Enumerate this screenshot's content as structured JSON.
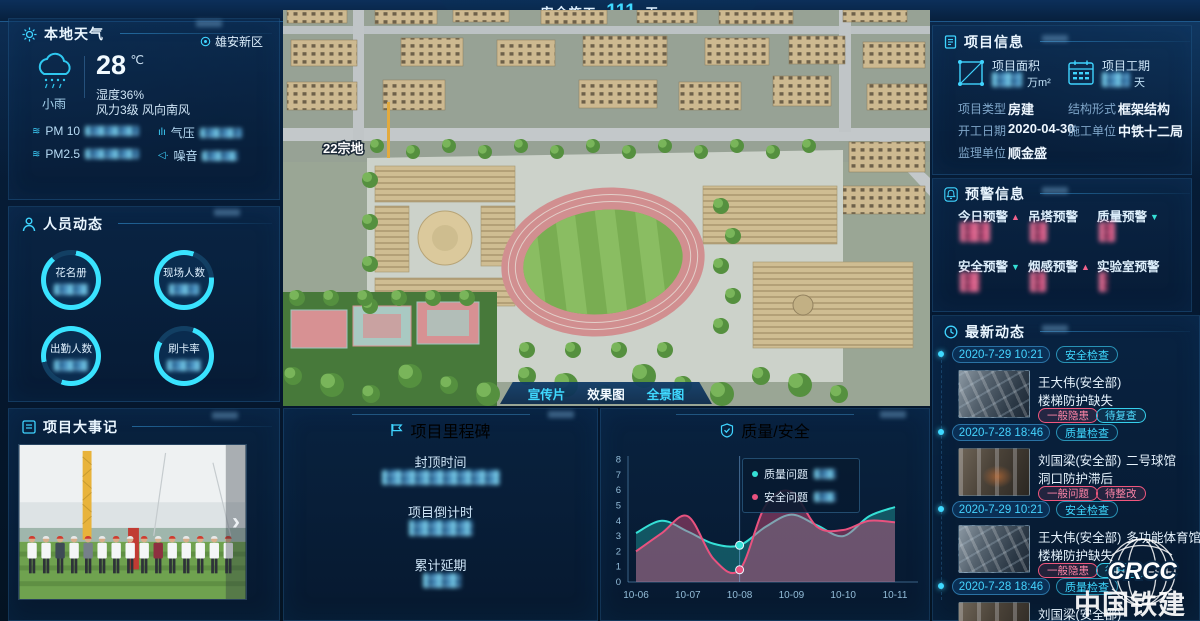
{
  "header": {
    "prefix": "安全施工",
    "days": "111",
    "suffix": "天"
  },
  "weather": {
    "title": "本地天气",
    "region": "雄安新区",
    "condition": "小雨",
    "temperature": "28",
    "temp_unit": "℃",
    "humidity": "湿度36%",
    "wind": "风力3级 风向南风",
    "metrics": [
      {
        "label": "PM 10",
        "icon": "pm-waves-icon"
      },
      {
        "label": "气压",
        "icon": "pressure-icon"
      },
      {
        "label": "PM2.5",
        "icon": "pm-waves-icon"
      },
      {
        "label": "噪音",
        "icon": "noise-speaker-icon"
      }
    ]
  },
  "personnel": {
    "title": "人员动态",
    "gauges": [
      {
        "label": "花名册"
      },
      {
        "label": "现场人数"
      },
      {
        "label": "出勤人数"
      },
      {
        "label": "刷卡率"
      }
    ]
  },
  "events": {
    "title": "项目大事记",
    "next_label": "›"
  },
  "scene": {
    "plot_label": "22宗地",
    "buttons": [
      {
        "label": "宣传片",
        "active": false
      },
      {
        "label": "效果图",
        "active": true
      },
      {
        "label": "全景图",
        "active": false
      }
    ]
  },
  "milestone": {
    "title": "项目里程碑",
    "items": [
      {
        "label": "封顶时间"
      },
      {
        "label": "项目倒计时"
      },
      {
        "label": "累计延期"
      }
    ]
  },
  "project_info": {
    "title": "项目信息",
    "stats": [
      {
        "label": "项目面积",
        "unit": "万m²"
      },
      {
        "label": "项目工期",
        "unit": "天"
      }
    ],
    "fields": [
      {
        "label": "项目类型",
        "value": "房建"
      },
      {
        "label": "结构形式",
        "value": "框架结构"
      },
      {
        "label": "开工日期",
        "value": "2020-04-30"
      },
      {
        "label": "施工单位",
        "value": "中铁十二局"
      },
      {
        "label": "监理单位",
        "value": "顺金盛"
      }
    ]
  },
  "warnings": {
    "title": "预警信息",
    "items": [
      {
        "label": "今日预警",
        "trend": "up",
        "arrow": "▲"
      },
      {
        "label": "吊塔预警",
        "trend": "none",
        "arrow": ""
      },
      {
        "label": "质量预警",
        "trend": "down",
        "arrow": "▼"
      },
      {
        "label": "安全预警",
        "trend": "down",
        "arrow": "▼"
      },
      {
        "label": "烟感预警",
        "trend": "up",
        "arrow": "▲"
      },
      {
        "label": "实验室预警",
        "trend": "none",
        "arrow": ""
      }
    ]
  },
  "news": {
    "title": "最新动态",
    "items": [
      {
        "date": "2020-7-29 10:21",
        "category": "安全检查",
        "name": "王大伟(安全部)",
        "location": "",
        "issue": "楼梯防护缺失",
        "tag1": "一般隐患",
        "tag2": "待复查"
      },
      {
        "date": "2020-7-28 18:46",
        "category": "质量检查",
        "name": "刘国梁(安全部)",
        "location": "二号球馆",
        "issue": "洞口防护滞后",
        "tag1": "一般问题",
        "tag2": "待整改"
      },
      {
        "date": "2020-7-29 10:21",
        "category": "安全检查",
        "name": "王大伟(安全部)",
        "location": "多功能体育馆",
        "issue": "楼梯防护缺失",
        "tag1": "一般隐患",
        "tag2": "待复查"
      },
      {
        "date": "2020-7-28 18:46",
        "category": "质量检查",
        "name": "刘国梁(安全部)",
        "location": "",
        "issue": "",
        "tag1": "",
        "tag2": ""
      }
    ]
  },
  "logo": {
    "brand": "CRCC",
    "name": "中国铁建"
  },
  "chart_data": {
    "type": "area",
    "title": "质量/安全",
    "x_labels": [
      "10-06",
      "10-07",
      "10-08",
      "10-09",
      "10-10",
      "10-11"
    ],
    "ylim": [
      0,
      8
    ],
    "y_ticks": [
      0,
      1,
      2,
      3,
      4,
      5,
      6,
      7,
      8
    ],
    "marker_x": 2,
    "legend_position": "tooltip-at-10-08",
    "grid": false,
    "series": [
      {
        "name": "质量问题",
        "color": "#35e0d6",
        "fill": "rgba(47,217,206,0.30)",
        "x": [
          0,
          0.5,
          1,
          1.5,
          2,
          2.5,
          3,
          3.5,
          4,
          4.5,
          5
        ],
        "values": [
          3.2,
          4.0,
          3.3,
          2.5,
          2.4,
          3.6,
          4.4,
          3.7,
          3.0,
          4.3,
          4.9
        ]
      },
      {
        "name": "安全问题",
        "color": "#e8527f",
        "fill": "rgba(232,82,127,0.42)",
        "x": [
          0,
          0.5,
          1,
          1.5,
          2,
          2.5,
          3,
          3.5,
          4,
          4.5,
          5
        ],
        "values": [
          2.0,
          3.2,
          4.3,
          1.5,
          0.8,
          5.0,
          5.9,
          3.6,
          3.4,
          4.0,
          3.9
        ]
      }
    ]
  }
}
